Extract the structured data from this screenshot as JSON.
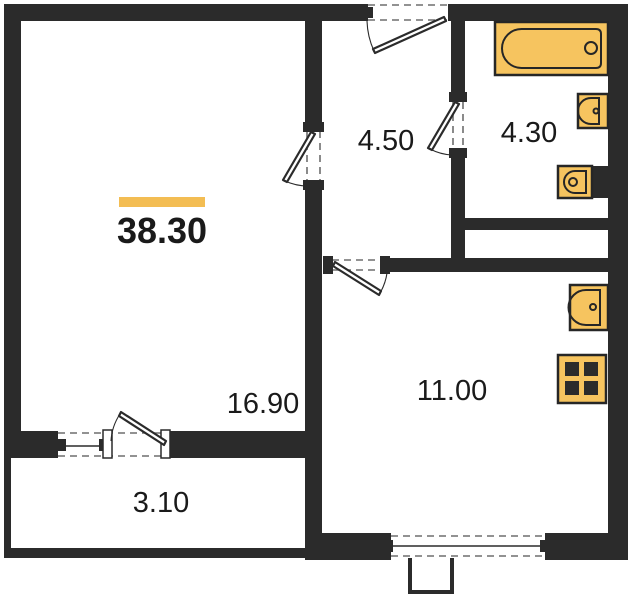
{
  "plan": {
    "total_area": {
      "value": "38.30"
    },
    "rooms": [
      {
        "id": "living-room",
        "label": "16.90"
      },
      {
        "id": "hallway",
        "label": "4.50"
      },
      {
        "id": "bathroom",
        "label": "4.30"
      },
      {
        "id": "kitchen",
        "label": "11.00"
      },
      {
        "id": "balcony",
        "label": "3.10"
      }
    ],
    "fixtures": [
      "bathtub-icon",
      "bathroom-sink-icon",
      "toilet-icon",
      "kitchen-sink-icon",
      "stove-icon"
    ],
    "colors": {
      "wall": "#2b2b2b",
      "fixture": "#f6c45f",
      "fixture_outline": "#262626",
      "accent_bar": "#f3bd53",
      "dash": "#6e6e6e",
      "background": "#ffffff"
    }
  }
}
